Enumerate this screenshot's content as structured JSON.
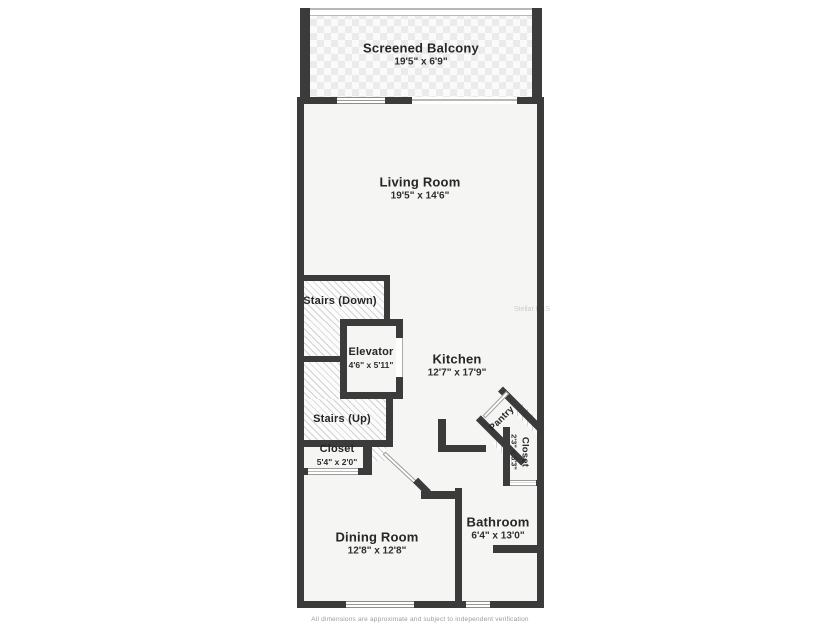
{
  "floorplan": {
    "rooms": [
      {
        "id": "screened_balcony",
        "name": "Screened Balcony",
        "dims": "19'5\" x 6'9\""
      },
      {
        "id": "living_room",
        "name": "Living Room",
        "dims": "19'5\" x 14'6\""
      },
      {
        "id": "stairs_down",
        "name": "Stairs (Down)",
        "dims": ""
      },
      {
        "id": "elevator",
        "name": "Elevator",
        "dims": "4'6\" x 5'11\""
      },
      {
        "id": "kitchen",
        "name": "Kitchen",
        "dims": "12'7\" x 17'9\""
      },
      {
        "id": "stairs_up",
        "name": "Stairs (Up)",
        "dims": ""
      },
      {
        "id": "closet_hall",
        "name": "Closet",
        "dims": "5'4\" x 2'0\""
      },
      {
        "id": "pantry",
        "name": "Pantry",
        "dims": ""
      },
      {
        "id": "closet_bath",
        "name": "Closet",
        "dims": "2'3\" x 5'3\""
      },
      {
        "id": "dining_room",
        "name": "Dining Room",
        "dims": "12'8\" x 12'8\""
      },
      {
        "id": "bathroom",
        "name": "Bathroom",
        "dims": "6'4\" x 13'0\""
      }
    ],
    "watermark": "Stellar MLS",
    "disclaimer": "All dimensions are approximate and subject to independent verification",
    "colors": {
      "wall": "#3b3b3b",
      "room_fill": "#f5f5f3",
      "hatch_line": "#d2d2d2",
      "text": "#262626"
    }
  }
}
